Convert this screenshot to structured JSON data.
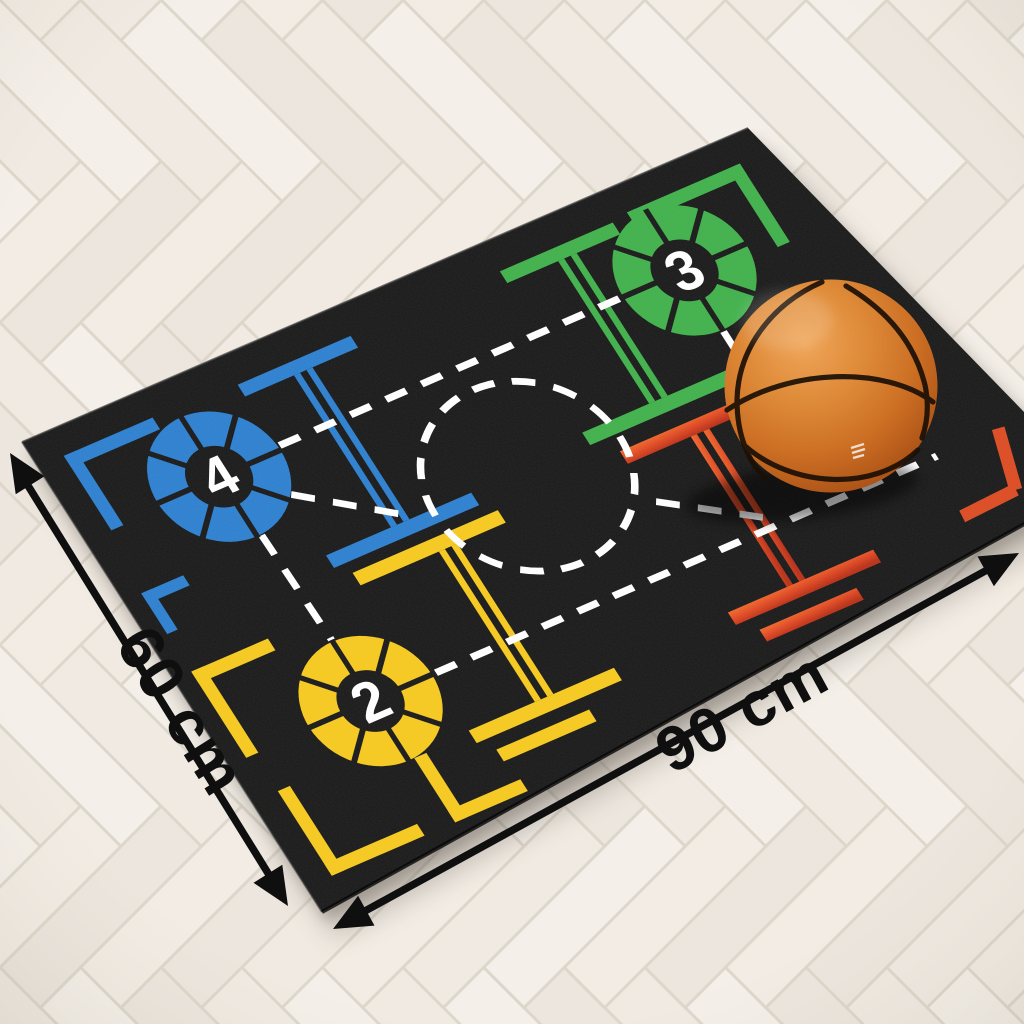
{
  "product_view": {
    "dimensions": {
      "width_label": "90 cm",
      "height_label": "60 cm"
    },
    "mat": {
      "spots": [
        {
          "number": "4",
          "color_name": "blue"
        },
        {
          "number": "3",
          "color_name": "green"
        },
        {
          "number": "2",
          "color_name": "yellow"
        }
      ]
    },
    "colors": {
      "blue": "#2b7fd0",
      "green": "#3fb04a",
      "yellow": "#f6c91d",
      "red": "#dc4a21",
      "mat_black": "#181818",
      "floor_base": "#f1ece4",
      "arrow_black": "#0f0f0f",
      "marking_white": "#ffffff",
      "ball_orange": "#c97227"
    }
  }
}
